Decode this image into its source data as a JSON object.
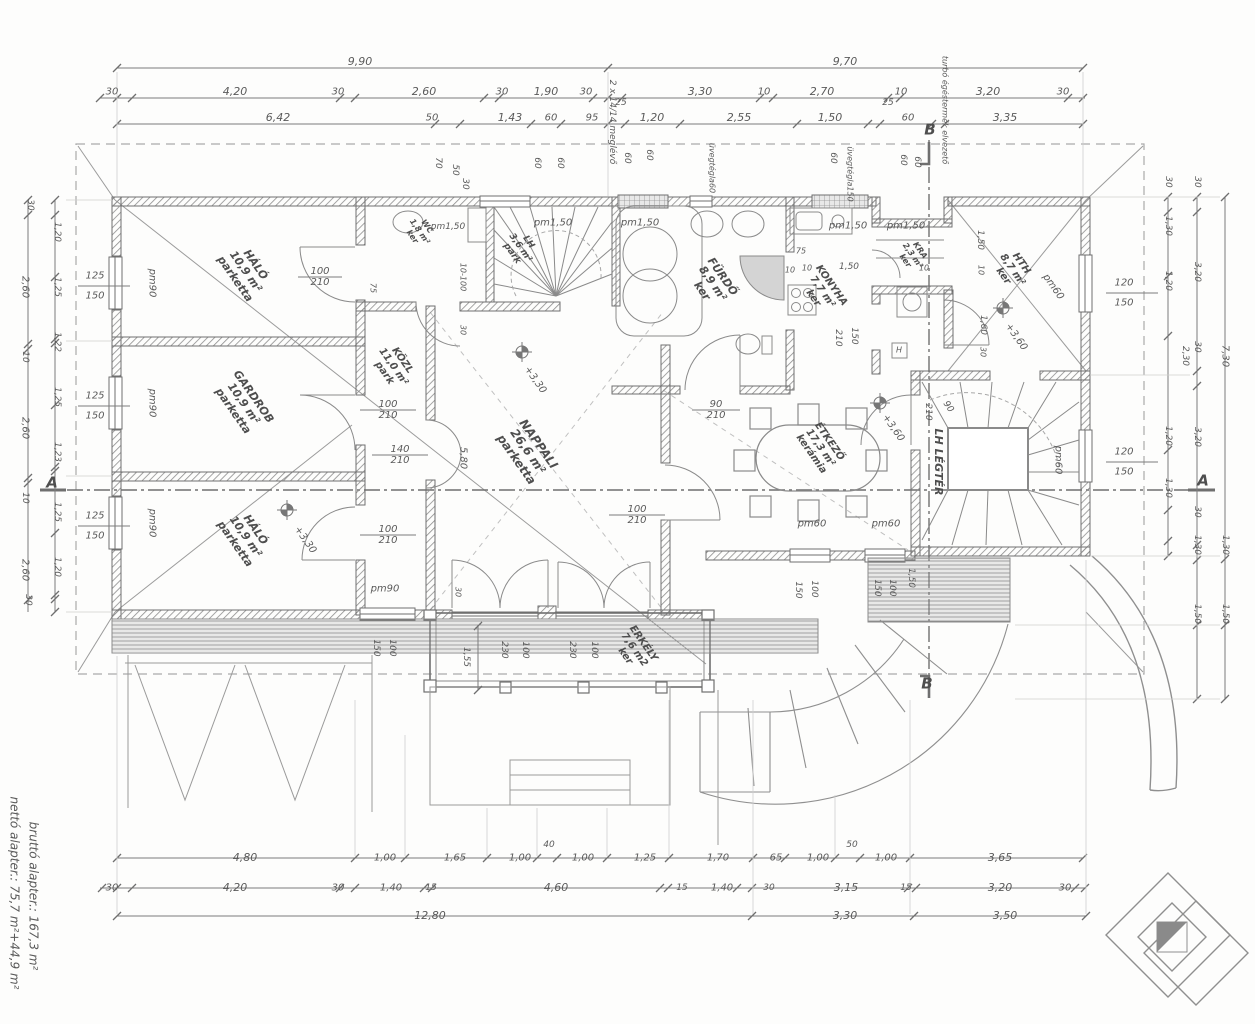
{
  "document": {
    "type": "architectural-floor-plan",
    "language": "Hungarian",
    "net_area_text": "nettó alapter.:   75,7 m²+44,9 m²",
    "gross_area_text": "bruttó alapter.:   167,3 m²",
    "section_markers": [
      "A",
      "A",
      "B",
      "B"
    ]
  },
  "colors": {
    "line": "#777777",
    "wall_hatch": "#8d8d8d",
    "text": "#5a5a5a",
    "shower_fill": "#d4d4d4",
    "north_triangle": "#8a8a8a",
    "background": "#fdfdfc"
  },
  "rooms": [
    {
      "name": "HÁLÓ",
      "area": "10,9 m²",
      "floor": "parketta"
    },
    {
      "name": "GARDROB",
      "area": "10,9 m²",
      "floor": "parketta"
    },
    {
      "name": "HÁLÓ",
      "area": "10,9 m²",
      "floor": "parketta"
    },
    {
      "name": "KÖZL",
      "area": "11,0 m²",
      "floor": "park"
    },
    {
      "name": "WC",
      "area": "1,8 m²",
      "floor": "ker"
    },
    {
      "name": "LH",
      "area": "3,6 m²",
      "floor": "park"
    },
    {
      "name": "NAPPALI",
      "area": "26,6 m²",
      "floor": "parketta"
    },
    {
      "name": "FÜRDŐ",
      "area": "8,9 m²",
      "floor": "ker"
    },
    {
      "name": "KONYHA",
      "area": "7,7 m²",
      "floor": "ker"
    },
    {
      "name": "KRA",
      "area": "2,3 m²",
      "floor": "ker"
    },
    {
      "name": "HTH",
      "area": "8,7 m²",
      "floor": "ker"
    },
    {
      "name": "ÉTKEZŐ",
      "area": "17,3 m²",
      "floor": "kerámia"
    },
    {
      "name": "LH LÉGTÉR",
      "area": "",
      "floor": ""
    },
    {
      "name": "ERKÉLY",
      "area": "7,6 m2",
      "floor": "ker"
    }
  ],
  "labels": [
    {
      "t": "9,90",
      "x": 360,
      "y": 62,
      "s": 11
    },
    {
      "t": "9,70",
      "x": 845,
      "y": 62,
      "s": 11
    },
    {
      "t": "30",
      "x": 112,
      "y": 92,
      "s": 10
    },
    {
      "t": "4,20",
      "x": 235,
      "y": 92,
      "s": 11
    },
    {
      "t": "30",
      "x": 338,
      "y": 92,
      "s": 10
    },
    {
      "t": "2,60",
      "x": 424,
      "y": 92,
      "s": 11
    },
    {
      "t": "30",
      "x": 502,
      "y": 92,
      "s": 10
    },
    {
      "t": "1,90",
      "x": 546,
      "y": 92,
      "s": 11
    },
    {
      "t": "30",
      "x": 586,
      "y": 92,
      "s": 10
    },
    {
      "t": "25",
      "x": 621,
      "y": 103,
      "s": 9
    },
    {
      "t": "3,30",
      "x": 700,
      "y": 92,
      "s": 11
    },
    {
      "t": "10",
      "x": 764,
      "y": 92,
      "s": 10
    },
    {
      "t": "2,70",
      "x": 822,
      "y": 92,
      "s": 11
    },
    {
      "t": "25",
      "x": 888,
      "y": 103,
      "s": 9
    },
    {
      "t": "10",
      "x": 901,
      "y": 92,
      "s": 10
    },
    {
      "t": "3,20",
      "x": 988,
      "y": 92,
      "s": 11
    },
    {
      "t": "30",
      "x": 1063,
      "y": 92,
      "s": 10
    },
    {
      "t": "6,42",
      "x": 278,
      "y": 118,
      "s": 11
    },
    {
      "t": "50",
      "x": 432,
      "y": 118,
      "s": 10
    },
    {
      "t": "1,43",
      "x": 510,
      "y": 118,
      "s": 11
    },
    {
      "t": "60",
      "x": 551,
      "y": 118,
      "s": 10
    },
    {
      "t": "95",
      "x": 592,
      "y": 118,
      "s": 10
    },
    {
      "t": "1,20",
      "x": 652,
      "y": 118,
      "s": 11
    },
    {
      "t": "2,55",
      "x": 739,
      "y": 118,
      "s": 11
    },
    {
      "t": "1,50",
      "x": 830,
      "y": 118,
      "s": 11
    },
    {
      "t": "60",
      "x": 908,
      "y": 118,
      "s": 10
    },
    {
      "t": "3,35",
      "x": 1005,
      "y": 118,
      "s": 11
    },
    {
      "t": "2 x 14/14 meglévő",
      "x": 612,
      "y": 122,
      "r": 90,
      "s": 9
    },
    {
      "t": "70",
      "x": 438,
      "y": 163,
      "r": 90,
      "s": 9
    },
    {
      "t": "50",
      "x": 455,
      "y": 170,
      "r": 90,
      "s": 9
    },
    {
      "t": "30",
      "x": 465,
      "y": 184,
      "r": 90,
      "s": 9
    },
    {
      "t": "60",
      "x": 537,
      "y": 163,
      "r": 90,
      "s": 9
    },
    {
      "t": "60",
      "x": 560,
      "y": 163,
      "r": 90,
      "s": 9
    },
    {
      "t": "60",
      "x": 627,
      "y": 158,
      "r": 90,
      "s": 9
    },
    {
      "t": "60",
      "x": 649,
      "y": 155,
      "r": 90,
      "s": 9
    },
    {
      "t": "üvegtégla60",
      "x": 711,
      "y": 168,
      "r": 90,
      "s": 8
    },
    {
      "t": "60",
      "x": 833,
      "y": 158,
      "r": 90,
      "s": 9
    },
    {
      "t": "üvegtégla150",
      "x": 849,
      "y": 174,
      "r": 90,
      "s": 8
    },
    {
      "t": "60",
      "x": 903,
      "y": 160,
      "r": 90,
      "s": 9
    },
    {
      "t": "60",
      "x": 917,
      "y": 162,
      "r": 90,
      "s": 9
    },
    {
      "t": "B",
      "x": 930,
      "y": 130,
      "s": 15,
      "b": 1,
      "n": "section-marker-b"
    },
    {
      "t": "turbó égéstermék elvezető",
      "x": 944,
      "y": 110,
      "r": 90,
      "s": 8
    },
    {
      "t": "30",
      "x": 30,
      "y": 205,
      "r": 90,
      "s": 9
    },
    {
      "t": "2,60",
      "x": 25,
      "y": 287,
      "r": 90,
      "s": 10
    },
    {
      "t": "10",
      "x": 25,
      "y": 357,
      "r": 90,
      "s": 9
    },
    {
      "t": "2,60",
      "x": 25,
      "y": 428,
      "r": 90,
      "s": 10
    },
    {
      "t": "10",
      "x": 25,
      "y": 498,
      "r": 90,
      "s": 9
    },
    {
      "t": "2,60",
      "x": 25,
      "y": 570,
      "r": 90,
      "s": 10
    },
    {
      "t": "30",
      "x": 28,
      "y": 600,
      "r": 90,
      "s": 9
    },
    {
      "t": "1,20",
      "x": 57,
      "y": 232,
      "r": 90,
      "s": 9
    },
    {
      "t": "1,25",
      "x": 57,
      "y": 287,
      "r": 90,
      "s": 9
    },
    {
      "t": "1,22",
      "x": 57,
      "y": 342,
      "r": 90,
      "s": 9
    },
    {
      "t": "1,25",
      "x": 57,
      "y": 397,
      "r": 90,
      "s": 9
    },
    {
      "t": "1,23",
      "x": 57,
      "y": 452,
      "r": 90,
      "s": 9
    },
    {
      "t": "1,25",
      "x": 57,
      "y": 512,
      "r": 90,
      "s": 9
    },
    {
      "t": "1,20",
      "x": 57,
      "y": 567,
      "r": 90,
      "s": 9
    },
    {
      "t": "125",
      "x": 95,
      "y": 276,
      "s": 10
    },
    {
      "t": "150",
      "x": 95,
      "y": 296,
      "s": 10
    },
    {
      "t": "125",
      "x": 95,
      "y": 396,
      "s": 10
    },
    {
      "t": "150",
      "x": 95,
      "y": 416,
      "s": 10
    },
    {
      "t": "125",
      "x": 95,
      "y": 516,
      "s": 10
    },
    {
      "t": "150",
      "x": 95,
      "y": 536,
      "s": 10
    },
    {
      "t": "A",
      "x": 52,
      "y": 483,
      "s": 15,
      "b": 1,
      "n": "section-marker-a"
    },
    {
      "t": "pm90",
      "x": 152,
      "y": 283,
      "r": 90,
      "s": 10
    },
    {
      "t": "pm90",
      "x": 152,
      "y": 403,
      "r": 90,
      "s": 10
    },
    {
      "t": "pm90",
      "x": 152,
      "y": 523,
      "r": 90,
      "s": 10
    },
    {
      "t": "30",
      "x": 1168,
      "y": 182,
      "r": 90,
      "s": 9
    },
    {
      "t": "1,30",
      "x": 1168,
      "y": 226,
      "r": 90,
      "s": 9
    },
    {
      "t": "1,20",
      "x": 1168,
      "y": 281,
      "r": 90,
      "s": 9
    },
    {
      "t": "2,30",
      "x": 1185,
      "y": 356,
      "r": 90,
      "s": 9
    },
    {
      "t": "1,20",
      "x": 1168,
      "y": 436,
      "r": 90,
      "s": 9
    },
    {
      "t": "1,30",
      "x": 1168,
      "y": 488,
      "r": 90,
      "s": 9
    },
    {
      "t": "30",
      "x": 1197,
      "y": 182,
      "r": 90,
      "s": 9
    },
    {
      "t": "3,20",
      "x": 1197,
      "y": 272,
      "r": 90,
      "s": 9
    },
    {
      "t": "30",
      "x": 1197,
      "y": 347,
      "r": 90,
      "s": 9
    },
    {
      "t": "3,20",
      "x": 1197,
      "y": 437,
      "r": 90,
      "s": 9
    },
    {
      "t": "30",
      "x": 1197,
      "y": 512,
      "r": 90,
      "s": 9
    },
    {
      "t": "1,30",
      "x": 1197,
      "y": 545,
      "r": 90,
      "s": 9
    },
    {
      "t": "1,50",
      "x": 1197,
      "y": 614,
      "r": 90,
      "s": 9
    },
    {
      "t": "7,30",
      "x": 1225,
      "y": 356,
      "r": 90,
      "s": 10
    },
    {
      "t": "1,30",
      "x": 1225,
      "y": 545,
      "r": 90,
      "s": 9
    },
    {
      "t": "1,50",
      "x": 1225,
      "y": 614,
      "r": 90,
      "s": 9
    },
    {
      "t": "A",
      "x": 1203,
      "y": 481,
      "s": 15,
      "b": 1,
      "n": "section-marker-a"
    },
    {
      "t": "120",
      "x": 1124,
      "y": 283,
      "s": 10
    },
    {
      "t": "150",
      "x": 1124,
      "y": 303,
      "s": 10
    },
    {
      "t": "120",
      "x": 1124,
      "y": 452,
      "s": 10
    },
    {
      "t": "150",
      "x": 1124,
      "y": 472,
      "s": 10
    },
    {
      "t": "pm60",
      "x": 1053,
      "y": 287,
      "r": 55,
      "s": 10
    },
    {
      "t": "pm60",
      "x": 1058,
      "y": 460,
      "r": 90,
      "s": 10
    },
    {
      "t": "4,80",
      "x": 245,
      "y": 858,
      "s": 11
    },
    {
      "t": "1,00",
      "x": 385,
      "y": 858,
      "s": 10
    },
    {
      "t": "1,65",
      "x": 455,
      "y": 858,
      "s": 10
    },
    {
      "t": "1,00",
      "x": 520,
      "y": 858,
      "s": 10
    },
    {
      "t": "40",
      "x": 549,
      "y": 845,
      "s": 9
    },
    {
      "t": "1,00",
      "x": 583,
      "y": 858,
      "s": 10
    },
    {
      "t": "1,25",
      "x": 645,
      "y": 858,
      "s": 10
    },
    {
      "t": "1,70",
      "x": 718,
      "y": 858,
      "s": 10
    },
    {
      "t": "65",
      "x": 776,
      "y": 858,
      "s": 10
    },
    {
      "t": "1,00",
      "x": 818,
      "y": 858,
      "s": 10
    },
    {
      "t": "50",
      "x": 852,
      "y": 845,
      "s": 9
    },
    {
      "t": "1,00",
      "x": 886,
      "y": 858,
      "s": 10
    },
    {
      "t": "3,65",
      "x": 1000,
      "y": 858,
      "s": 11
    },
    {
      "t": "30",
      "x": 112,
      "y": 888,
      "s": 10
    },
    {
      "t": "4,20",
      "x": 235,
      "y": 888,
      "s": 11
    },
    {
      "t": "30",
      "x": 338,
      "y": 888,
      "s": 10
    },
    {
      "t": "1,40",
      "x": 391,
      "y": 888,
      "s": 10
    },
    {
      "t": "15",
      "x": 431,
      "y": 888,
      "s": 9
    },
    {
      "t": "4,60",
      "x": 556,
      "y": 888,
      "s": 11
    },
    {
      "t": "15",
      "x": 682,
      "y": 888,
      "s": 9
    },
    {
      "t": "1,40",
      "x": 722,
      "y": 888,
      "s": 10
    },
    {
      "t": "30",
      "x": 769,
      "y": 888,
      "s": 9
    },
    {
      "t": "3,15",
      "x": 846,
      "y": 888,
      "s": 11
    },
    {
      "t": "15",
      "x": 906,
      "y": 888,
      "s": 9
    },
    {
      "t": "3,20",
      "x": 1000,
      "y": 888,
      "s": 11
    },
    {
      "t": "30",
      "x": 1065,
      "y": 888,
      "s": 10
    },
    {
      "t": "12,80",
      "x": 430,
      "y": 916,
      "s": 11
    },
    {
      "t": "3,30",
      "x": 845,
      "y": 916,
      "s": 11
    },
    {
      "t": "3,50",
      "x": 1005,
      "y": 916,
      "s": 11
    },
    {
      "t": "nettó alapter.:   75,7 m²+44,9 m²",
      "x": 14,
      "y": 893,
      "r": 90,
      "s": 12,
      "n": "net-area-text"
    },
    {
      "t": "bruttó alapter.:   167,3 m²",
      "x": 33,
      "y": 896,
      "r": 90,
      "s": 12,
      "n": "gross-area-text"
    },
    {
      "t": "HÁLÓ\n10,9 m²\nparketta",
      "x": 245,
      "y": 272,
      "r": 55,
      "s": 11,
      "b": 1,
      "n": "room-label-halo-1"
    },
    {
      "t": "GARDROB\n10,9 m²\nparketta",
      "x": 243,
      "y": 404,
      "r": 55,
      "s": 11,
      "b": 1,
      "n": "room-label-gardrob"
    },
    {
      "t": "HÁLÓ\n10,9 m²\nparketta",
      "x": 245,
      "y": 537,
      "r": 55,
      "s": 11,
      "b": 1,
      "n": "room-label-halo-2"
    },
    {
      "t": "KÖZL\n11,0 m²\npark",
      "x": 393,
      "y": 367,
      "r": 55,
      "s": 10,
      "b": 1,
      "n": "room-label-kozl"
    },
    {
      "t": "WC\n1,8 m²\nker",
      "x": 419,
      "y": 232,
      "r": 55,
      "s": 8,
      "b": 1,
      "n": "room-label-wc"
    },
    {
      "t": "LH\n3,6 m²\npark",
      "x": 520,
      "y": 248,
      "r": 55,
      "s": 9,
      "b": 1,
      "n": "room-label-lh"
    },
    {
      "t": "NAPPALI\n26,6 m²\nparketta",
      "x": 527,
      "y": 452,
      "r": 55,
      "s": 12,
      "b": 1,
      "n": "room-label-nappali"
    },
    {
      "t": "FÜRDŐ\n8,9 m²\nker",
      "x": 712,
      "y": 284,
      "r": 55,
      "s": 11,
      "b": 1,
      "n": "room-label-furdo"
    },
    {
      "t": "KONYHA\n7,7 m²\nker",
      "x": 822,
      "y": 292,
      "r": 55,
      "s": 10,
      "b": 1,
      "n": "room-label-konyha"
    },
    {
      "t": "KRA\n2,3 m²\nker",
      "x": 912,
      "y": 256,
      "r": 55,
      "s": 8,
      "b": 1,
      "n": "room-label-kra"
    },
    {
      "t": "HTH\n8,7 m²\nker",
      "x": 1012,
      "y": 270,
      "r": 55,
      "s": 10,
      "b": 1,
      "n": "room-label-hth"
    },
    {
      "t": "ÉTKEZŐ\n17,3 m²\nkerámia",
      "x": 820,
      "y": 448,
      "r": 55,
      "s": 10,
      "b": 1,
      "n": "room-label-etkezo"
    },
    {
      "t": "LH LÉGTÉR",
      "x": 938,
      "y": 462,
      "r": 90,
      "s": 11,
      "b": 1,
      "n": "room-label-lh-legter"
    },
    {
      "t": "ERKÉLY\n7,6 m2\nker",
      "x": 634,
      "y": 650,
      "r": 55,
      "s": 10,
      "b": 1,
      "n": "room-label-erkely"
    },
    {
      "t": "+3,30",
      "x": 535,
      "y": 380,
      "r": 55,
      "s": 10
    },
    {
      "t": "+3,30",
      "x": 305,
      "y": 540,
      "r": 55,
      "s": 10
    },
    {
      "t": "+3,60",
      "x": 893,
      "y": 428,
      "r": 55,
      "s": 10
    },
    {
      "t": "+3,60",
      "x": 1016,
      "y": 337,
      "r": 55,
      "s": 10
    },
    {
      "t": "100\n210",
      "x": 320,
      "y": 277,
      "s": 10
    },
    {
      "t": "100\n210",
      "x": 388,
      "y": 410,
      "s": 10
    },
    {
      "t": "100\n210",
      "x": 388,
      "y": 535,
      "s": 10
    },
    {
      "t": "140\n210",
      "x": 400,
      "y": 455,
      "s": 10
    },
    {
      "t": "100\n210",
      "x": 637,
      "y": 515,
      "s": 10
    },
    {
      "t": "90\n210",
      "x": 716,
      "y": 410,
      "s": 10
    },
    {
      "t": "5,80",
      "x": 463,
      "y": 458,
      "r": 90,
      "s": 10
    },
    {
      "t": "10-100",
      "x": 462,
      "y": 277,
      "r": 90,
      "s": 8
    },
    {
      "t": "30",
      "x": 462,
      "y": 330,
      "r": 90,
      "s": 8
    },
    {
      "t": "75",
      "x": 372,
      "y": 288,
      "r": 90,
      "s": 8
    },
    {
      "t": "pm1,50",
      "x": 448,
      "y": 227,
      "s": 9
    },
    {
      "t": "pm1,50",
      "x": 553,
      "y": 223,
      "s": 10
    },
    {
      "t": "pm1,50",
      "x": 640,
      "y": 223,
      "s": 10
    },
    {
      "t": "pm1,50",
      "x": 848,
      "y": 226,
      "s": 10
    },
    {
      "t": "pm1,50",
      "x": 906,
      "y": 226,
      "s": 10
    },
    {
      "t": "pm90",
      "x": 385,
      "y": 589,
      "s": 10
    },
    {
      "t": "pm60",
      "x": 812,
      "y": 524,
      "s": 10
    },
    {
      "t": "pm60",
      "x": 886,
      "y": 524,
      "s": 10
    },
    {
      "t": "150",
      "x": 798,
      "y": 590,
      "r": 90,
      "s": 9
    },
    {
      "t": "100",
      "x": 814,
      "y": 589,
      "r": 90,
      "s": 9
    },
    {
      "t": "150",
      "x": 877,
      "y": 588,
      "r": 90,
      "s": 9
    },
    {
      "t": "100",
      "x": 892,
      "y": 588,
      "r": 90,
      "s": 9
    },
    {
      "t": "150",
      "x": 376,
      "y": 648,
      "r": 90,
      "s": 9
    },
    {
      "t": "100",
      "x": 392,
      "y": 648,
      "r": 90,
      "s": 9
    },
    {
      "t": "1,55",
      "x": 466,
      "y": 657,
      "r": 90,
      "s": 9
    },
    {
      "t": "230",
      "x": 504,
      "y": 650,
      "r": 90,
      "s": 9
    },
    {
      "t": "100",
      "x": 525,
      "y": 650,
      "r": 90,
      "s": 9
    },
    {
      "t": "230",
      "x": 572,
      "y": 650,
      "r": 90,
      "s": 9
    },
    {
      "t": "100",
      "x": 594,
      "y": 650,
      "r": 90,
      "s": 9
    },
    {
      "t": "30",
      "x": 457,
      "y": 592,
      "r": 90,
      "s": 8
    },
    {
      "t": "90",
      "x": 948,
      "y": 407,
      "r": 55,
      "s": 9
    },
    {
      "t": "210",
      "x": 928,
      "y": 412,
      "r": 90,
      "s": 9
    },
    {
      "t": "1,50",
      "x": 980,
      "y": 240,
      "r": 90,
      "s": 9
    },
    {
      "t": "10",
      "x": 980,
      "y": 270,
      "r": 90,
      "s": 8
    },
    {
      "t": "1,60",
      "x": 983,
      "y": 325,
      "r": 90,
      "s": 9
    },
    {
      "t": "30",
      "x": 982,
      "y": 352,
      "r": 90,
      "s": 8
    },
    {
      "t": "10",
      "x": 790,
      "y": 271,
      "s": 8
    },
    {
      "t": "10",
      "x": 807,
      "y": 269,
      "s": 8
    },
    {
      "t": "1,50",
      "x": 849,
      "y": 267,
      "s": 9
    },
    {
      "t": "10",
      "x": 924,
      "y": 269,
      "s": 8
    },
    {
      "t": "75",
      "x": 801,
      "y": 252,
      "s": 8
    },
    {
      "t": "150",
      "x": 854,
      "y": 336,
      "r": 90,
      "s": 9
    },
    {
      "t": "210",
      "x": 838,
      "y": 338,
      "r": 90,
      "s": 9
    },
    {
      "t": "1,50",
      "x": 911,
      "y": 578,
      "r": 90,
      "s": 9
    },
    {
      "t": "H",
      "x": 899,
      "y": 351,
      "s": 8
    },
    {
      "t": "B",
      "x": 927,
      "y": 684,
      "s": 15,
      "b": 1,
      "n": "section-marker-b"
    }
  ]
}
